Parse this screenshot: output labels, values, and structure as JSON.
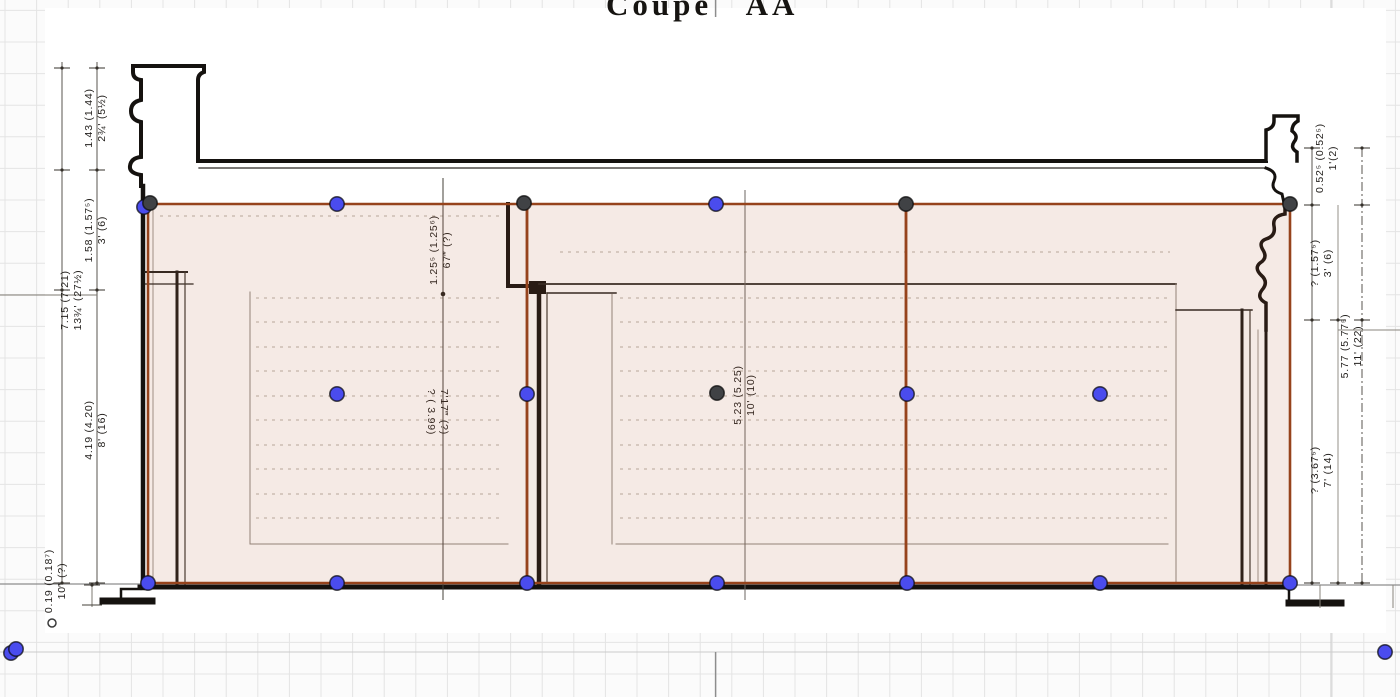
{
  "title": "Coupe   AA",
  "canvas": {
    "grid_color": "#e4e4e4",
    "grid_major_color": "#cbcbcb",
    "grid_spacing": 31.6,
    "paper_color": "#ffffff",
    "center_mark_x": 715.6
  },
  "annotation": {
    "edge_color": "#96431c",
    "fill_color": "rgba(178,92,52,0.13)",
    "vertex_colors": {
      "blue": "#4a4cee",
      "dark": "#404245"
    },
    "vertex_outline": "rgba(10,10,10,0.7)",
    "polygons": [
      {
        "name": "room-left",
        "points": [
          [
            148,
            204
          ],
          [
            527,
            204
          ],
          [
            527,
            583
          ],
          [
            148,
            583
          ]
        ]
      },
      {
        "name": "room-mid",
        "points": [
          [
            527,
            204
          ],
          [
            906,
            204
          ],
          [
            906,
            583
          ],
          [
            527,
            583
          ]
        ]
      },
      {
        "name": "room-right",
        "points": [
          [
            906,
            204
          ],
          [
            1290,
            204
          ],
          [
            1290,
            583
          ],
          [
            906,
            583
          ]
        ]
      }
    ],
    "vertices": [
      {
        "x": 144,
        "y": 207,
        "c": "blue"
      },
      {
        "x": 150,
        "y": 203,
        "c": "dark"
      },
      {
        "x": 337,
        "y": 204,
        "c": "blue"
      },
      {
        "x": 524,
        "y": 203,
        "c": "dark"
      },
      {
        "x": 716,
        "y": 204,
        "c": "blue"
      },
      {
        "x": 906,
        "y": 204,
        "c": "dark"
      },
      {
        "x": 1290,
        "y": 204,
        "c": "dark"
      },
      {
        "x": 337,
        "y": 394,
        "c": "blue"
      },
      {
        "x": 527,
        "y": 394,
        "c": "blue"
      },
      {
        "x": 717,
        "y": 393,
        "c": "dark"
      },
      {
        "x": 907,
        "y": 394,
        "c": "blue"
      },
      {
        "x": 1100,
        "y": 394,
        "c": "blue"
      },
      {
        "x": 148,
        "y": 583,
        "c": "blue"
      },
      {
        "x": 337,
        "y": 583,
        "c": "blue"
      },
      {
        "x": 527,
        "y": 583,
        "c": "blue"
      },
      {
        "x": 717,
        "y": 583,
        "c": "blue"
      },
      {
        "x": 907,
        "y": 583,
        "c": "blue"
      },
      {
        "x": 1100,
        "y": 583,
        "c": "blue"
      },
      {
        "x": 1290,
        "y": 583,
        "c": "blue"
      },
      {
        "x": 11,
        "y": 653,
        "c": "blue"
      },
      {
        "x": 16,
        "y": 649,
        "c": "blue"
      },
      {
        "x": 1385,
        "y": 652,
        "c": "blue"
      }
    ],
    "small_marker": {
      "x": 52,
      "y": 623
    }
  },
  "dimensions": [
    {
      "id": "left-1",
      "x": 96,
      "y": 118,
      "flip": false,
      "lines": [
        "1.43  (1.44)",
        "2¾'  (5½)"
      ]
    },
    {
      "id": "left-2",
      "x": 96,
      "y": 230,
      "flip": false,
      "lines": [
        "1.58  (1.57⁵)",
        "3'  (6)"
      ]
    },
    {
      "id": "left-overall",
      "x": 72,
      "y": 300,
      "flip": false,
      "lines": [
        "7.15  (7.21)",
        "13¾'  (27½)"
      ]
    },
    {
      "id": "left-3",
      "x": 96,
      "y": 430,
      "flip": false,
      "lines": [
        "4.19  (4.20)",
        "8'  (16)"
      ]
    },
    {
      "id": "left-floor",
      "x": 56,
      "y": 581,
      "flip": false,
      "lines": [
        "0.19 (0.18⁷)",
        "10‴ (?)"
      ]
    },
    {
      "id": "mid-upper",
      "x": 441,
      "y": 250,
      "flip": false,
      "lines": [
        "1.25⁵  (1.25⁶)",
        "67‴  (?)"
      ]
    },
    {
      "id": "mid-lower",
      "x": 437,
      "y": 412,
      "flip": true,
      "lines": [
        "7'17‴ (?)",
        "?  ( 3.99)"
      ]
    },
    {
      "id": "center",
      "x": 745,
      "y": 395,
      "flip": false,
      "lines": [
        "5.23  (5.25)",
        "10'  (10)"
      ]
    },
    {
      "id": "right-1",
      "x": 1327,
      "y": 158,
      "flip": false,
      "lines": [
        "0.52⁵  (0.52⁵)",
        "1'(2)"
      ]
    },
    {
      "id": "right-2",
      "x": 1322,
      "y": 263,
      "flip": false,
      "lines": [
        "?  (1.57⁵)",
        "3'  (6)"
      ]
    },
    {
      "id": "right-overall",
      "x": 1352,
      "y": 346,
      "flip": false,
      "lines": [
        "5.77  (5.77⁵)",
        "11'  (22)"
      ]
    },
    {
      "id": "right-3",
      "x": 1322,
      "y": 470,
      "flip": false,
      "lines": [
        "?  (3.67⁵)",
        "7'  (14)"
      ]
    }
  ]
}
